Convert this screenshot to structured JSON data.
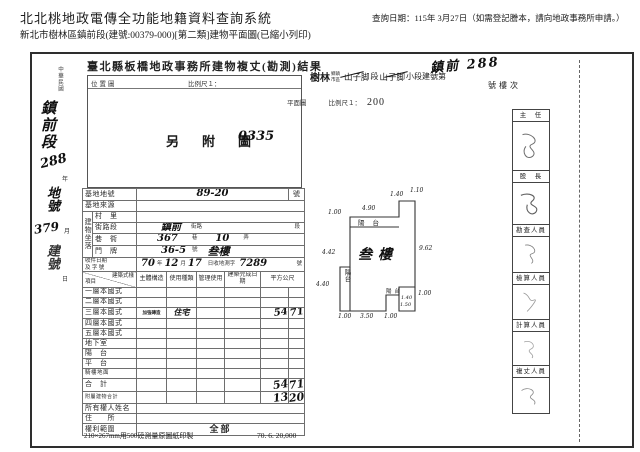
{
  "page_header": {
    "system_title": "北北桃地政電傳全功能地籍資料查詢系統",
    "query_date_note": "查詢日期：115年 3月27日（如需登記謄本，請向地政事務所申請。）",
    "doc_subtitle": "新北市樹林區鎮前段(建號:00379-000)[第二類]建物平面圖(已縮小列印)"
  },
  "document": {
    "result_title": "臺北縣板橋地政事務所建物複丈(勘測)結果",
    "margin": {
      "era": "中華民國",
      "year_unit": "年",
      "month_unit": "月",
      "day_unit": "日",
      "hw_section": "鎮前段",
      "hw_section_no": "288",
      "hw_land_label": "地號",
      "hw_bldg_no": "379",
      "hw_bldg_label": "建號"
    },
    "location_map": {
      "title": "位置圖",
      "scale_label": "比例尺１：",
      "note": "另　附　圖",
      "hw_note_no": "0335"
    },
    "plan": {
      "hw_retitle": "鎮前 288",
      "township": "樹林",
      "township_unit": "鄉鎮市區",
      "section_old": "山子脚",
      "section_unit": "段",
      "subsection_old": "山子脚",
      "subsection_unit": "小段建號第",
      "suffix": "號樓次",
      "plan_label": "平面圖",
      "scale_label": "比例尺１：",
      "scale_value": "200",
      "floor_label": "叁樓",
      "balcony_top": "陽台",
      "balcony_left": "陽台",
      "balcony_br": "陽台",
      "dims": {
        "top_left_h": "1.00",
        "top_w": "4.90",
        "step_w": "1.40",
        "step_h": "1.10",
        "right_h": "9.62",
        "left_mid": "4.42",
        "left_low": "4.40",
        "bottom_l": "1.00",
        "bottom_m": "3.50",
        "bottom_r": "1.00",
        "br_w": "1.40",
        "br_h": "1.50",
        "br_right": "1.00"
      }
    },
    "table": {
      "labels": {
        "site_no": "基地地號",
        "site_no_unit": "號",
        "site_src": "基地來源",
        "situs": "建物坐落",
        "village": "村　里",
        "street": "街路段",
        "street_unit1": "街路",
        "street_unit2": "段",
        "lane": "巷　衖",
        "lane_unit1": "巷",
        "lane_unit2": "弄",
        "door": "門　牌",
        "door_unit1": "號",
        "recv_line1": "收件日期",
        "recv_line2": "及 字 號",
        "recv_u_year": "年",
        "recv_u_month": "月",
        "recv_u_day": "日收地測字",
        "recv_u_no": "號",
        "hdr_item": "項目",
        "hdr_style": "建築式樣",
        "hdr_structure": "主體構造",
        "hdr_use": "使用種類",
        "hdr_manage": "管理使用",
        "hdr_done": "建築完成日期",
        "hdr_area": "平方公尺",
        "floor1": "一層本國式",
        "floor2": "二層本國式",
        "floor3": "三層本國式",
        "floor4": "四層本國式",
        "floor5": "五層本國式",
        "basement": "地下室",
        "balcony": "陽　台",
        "terrace": "平　台",
        "arcade": "騎樓地面",
        "total": "合　計",
        "annex_total": "附屬建物合計",
        "owner": "所有權人姓名",
        "address": "住　　所",
        "rights": "權利範圍"
      },
      "values": {
        "site_no": "89-20",
        "street": "鎮前",
        "lane": "367",
        "alley": "10",
        "door": "36-5",
        "door_floor": "叁樓",
        "recv_year": "70",
        "recv_month": "12",
        "recv_day": "17",
        "recv_no": "7289",
        "floor3_structure": "加強磚造",
        "floor3_use": "住宅",
        "floor3_area_int": "54",
        "floor3_area_dec": "71",
        "total_area_int": "54",
        "total_area_dec": "71",
        "annex_area_int": "13",
        "annex_area_dec": "20",
        "rights": "全部"
      }
    },
    "signoff": {
      "boxes": [
        "主　任",
        "股　長",
        "勘查人員",
        "檢算人員",
        "計算人員",
        "複丈人員"
      ]
    },
    "footer_note": "210×267mm用500磅測量原圖紙印製",
    "footer_code": "70. 6. 20,000"
  }
}
